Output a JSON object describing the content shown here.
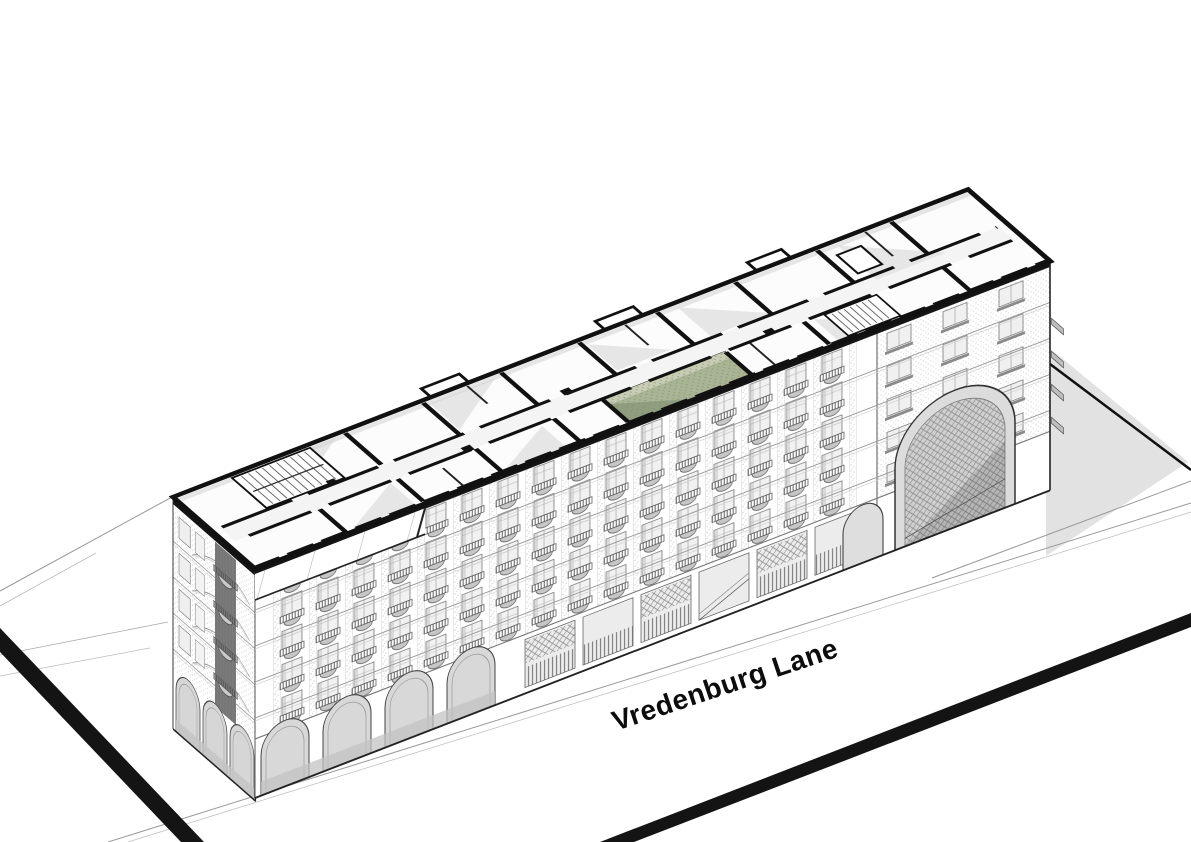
{
  "street_label": "Vredenburg Lane",
  "drawing": {
    "type": "axonometric cutaway",
    "subject": "residential block with top floor cut open to reveal the plan",
    "highlighted_unit": "single apartment highlighted in green on the cut plan"
  },
  "colors": {
    "paper": "#ffffff",
    "ink": "#141414",
    "highlight_unit": "#a9b494",
    "highlight_unit_light": "#c7ccb4",
    "highlight_unit_dark": "#8d9a7c",
    "ground_shadow": "#e2e2e2"
  }
}
